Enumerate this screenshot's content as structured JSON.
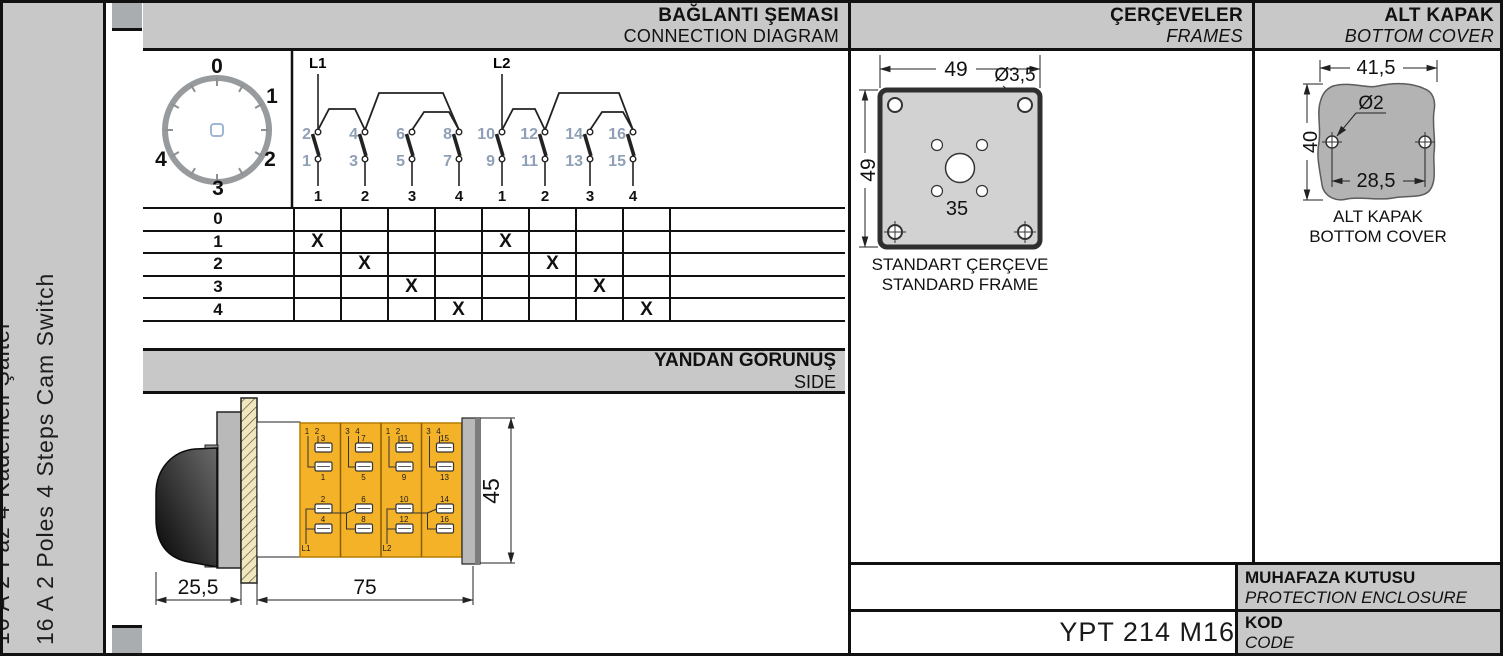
{
  "sidebar": {
    "title_tr": "16 A 2 Faz 4 Kademeli Şalter",
    "title_en": "16 A 2 Poles 4 Steps Cam Switch"
  },
  "connection": {
    "title_tr": "BAĞLANTI ŞEMASI",
    "title_en": "CONNECTION DIAGRAM",
    "dial_labels": [
      "0",
      "1",
      "2",
      "3",
      "4"
    ],
    "groups": [
      {
        "name": "L1",
        "top": [
          "2",
          "4",
          "6",
          "8"
        ],
        "bottom": [
          "1",
          "3",
          "5",
          "7"
        ],
        "outputs": [
          "1",
          "2",
          "3",
          "4"
        ]
      },
      {
        "name": "L2",
        "top": [
          "10",
          "12",
          "14",
          "16"
        ],
        "bottom": [
          "9",
          "11",
          "13",
          "15"
        ],
        "outputs": [
          "1",
          "2",
          "3",
          "4"
        ]
      }
    ],
    "table": {
      "row_labels": [
        "0",
        "1",
        "2",
        "3",
        "4"
      ],
      "marks": [
        [
          "",
          "",
          "",
          "",
          "",
          "",
          "",
          ""
        ],
        [
          "X",
          "",
          "",
          "",
          "X",
          "",
          "",
          ""
        ],
        [
          "",
          "X",
          "",
          "",
          "",
          "X",
          "",
          ""
        ],
        [
          "",
          "",
          "X",
          "",
          "",
          "",
          "X",
          ""
        ],
        [
          "",
          "",
          "",
          "X",
          "",
          "",
          "",
          "X"
        ]
      ]
    }
  },
  "side_view": {
    "title_tr": "YANDAN GÖRÜNÜŞ",
    "title_en": "SIDE",
    "dims": {
      "knob_depth": "25,5",
      "body_length": "75",
      "body_height": "45"
    },
    "modules": [
      {
        "lead_a": "1",
        "lead_b": "2",
        "upper_top": "3",
        "upper_bottom": "1",
        "lower_top": "2",
        "lower_bottom": "4",
        "feed": "L1"
      },
      {
        "lead_a": "3",
        "lead_b": "4",
        "upper_top": "7",
        "upper_bottom": "5",
        "lower_top": "6",
        "lower_bottom": "8",
        "feed": ""
      },
      {
        "lead_a": "1",
        "lead_b": "2",
        "upper_top": "11",
        "upper_bottom": "9",
        "lower_top": "10",
        "lower_bottom": "12",
        "feed": "L2"
      },
      {
        "lead_a": "3",
        "lead_b": "4",
        "upper_top": "15",
        "upper_bottom": "13",
        "lower_top": "14",
        "lower_bottom": "16",
        "feed": ""
      }
    ]
  },
  "frames": {
    "title_tr": "ÇERÇEVELER",
    "title_en": "FRAMES",
    "dim_width": "49",
    "dim_height": "49",
    "dim_corner_hole": "Ø3,5",
    "dim_center_span": "35",
    "caption_tr": "STANDART ÇERÇEVE",
    "caption_en": "STANDARD FRAME"
  },
  "bottom_cover": {
    "title_tr": "ALT KAPAK",
    "title_en": "BOTTOM COVER",
    "dim_width": "41,5",
    "dim_height": "40",
    "dim_hole": "Ø2",
    "dim_hole_span": "28,5",
    "caption_tr": "ALT KAPAK",
    "caption_en": "BOTTOM COVER"
  },
  "enclosure": {
    "label_tr": "MUHAFAZA KUTUSU",
    "label_en": "PROTECTION ENCLOSURE"
  },
  "code": {
    "label_tr": "KOD",
    "label_en": "CODE",
    "value": "YPT 214 M16"
  }
}
